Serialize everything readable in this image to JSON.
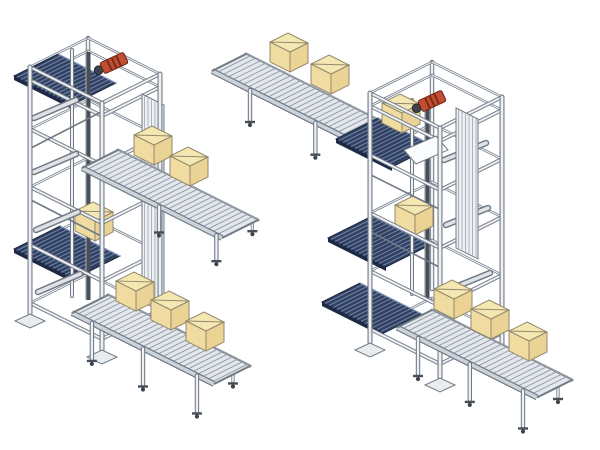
{
  "scene": {
    "width": 600,
    "height": 450,
    "background": "#ffffff"
  },
  "palette": {
    "frame_stroke": "#707a85",
    "frame_light": "#eef0f3",
    "frame_dark": "#474e57",
    "rail_light": "#ccd3da",
    "surface": "#e4e8ec",
    "roller": "#97a1ac",
    "belt": "#31405f",
    "belt_streak": "#7084ab",
    "belt_edge": "#1e2a45",
    "box_top": "#f5e7b2",
    "box_left": "#f0dca1",
    "box_right": "#ebd395",
    "box_stroke": "#93896c",
    "motor_red": "#c14e30",
    "motor_dark": "#7c2b18",
    "pulley": "#3d434b",
    "foot": "#e9ecef",
    "chute": "#fbfcfd"
  },
  "box_size": {
    "wa": 20,
    "wb": 18,
    "h": 20
  },
  "machines": [
    {
      "name": "vertical-conveyor-lift-left",
      "tower": {
        "n": [
          88,
          38
        ],
        "wa": 72,
        "wb": 58,
        "post_h": 252,
        "rings": [
          {
            "dy": 0
          },
          {
            "dy": 13
          },
          {
            "dy": 62
          },
          {
            "dy": 120
          },
          {
            "dy": 178
          },
          {
            "dy": 236
          }
        ],
        "decks": [
          {
            "p": [
              58,
              54
            ],
            "la": 58,
            "lb": 44
          },
          {
            "p": [
              60,
              226
            ],
            "la": 60,
            "lb": 46
          }
        ],
        "column": {
          "x": 88,
          "y1": 52,
          "y2": 300
        },
        "mast": {
          "x": 72,
          "y1": 50,
          "y2": 296
        },
        "arms": [
          [
            34,
            118,
            76,
            100
          ],
          [
            34,
            172,
            76,
            154
          ],
          [
            36,
            230,
            78,
            212
          ],
          [
            38,
            292,
            80,
            274
          ]
        ],
        "braces": [
          [
            31,
            148,
            101,
            112
          ],
          [
            31,
            200,
            101,
            236
          ]
        ],
        "guide_panel": {
          "p": [
            142,
            94
          ],
          "w": 22,
          "h": 200
        },
        "motor": {
          "cx": 114,
          "cy": 63,
          "angle": -25
        }
      },
      "tower_boxes": [
        {
          "n": [
            93,
            202
          ]
        }
      ],
      "conveyors": [
        {
          "name": "mid-level-outfeed-roller-conveyor",
          "layer": "front",
          "p": [
            118,
            150
          ],
          "len": 140,
          "w": 36,
          "leg_h": 24,
          "legs": [
            0.55,
            0.96
          ],
          "boxes": [
            {
              "n": [
                152,
                126
              ]
            },
            {
              "n": [
                188,
                147
              ]
            }
          ]
        },
        {
          "name": "bottom-outfeed-roller-conveyor",
          "layer": "front",
          "p": [
            108,
            295
          ],
          "len": 142,
          "w": 36,
          "leg_h": 36,
          "legs": [
            0.14,
            0.5,
            0.88
          ],
          "boxes": [
            {
              "n": [
                134,
                272
              ]
            },
            {
              "n": [
                169,
                291
              ]
            },
            {
              "n": [
                204,
                312
              ]
            }
          ]
        }
      ]
    },
    {
      "name": "vertical-conveyor-lift-right",
      "tower": {
        "n": [
          432,
          62
        ],
        "wa": 70,
        "wb": 62,
        "post_h": 255,
        "rings": [
          {
            "dy": 0
          },
          {
            "dy": 13
          },
          {
            "dy": 62
          },
          {
            "dy": 120
          },
          {
            "dy": 178
          },
          {
            "dy": 236
          }
        ],
        "decks": [
          {
            "p": [
              378,
              118
            ],
            "la": 56,
            "lb": 42
          },
          {
            "p": [
              372,
              216
            ],
            "la": 58,
            "lb": 44
          },
          {
            "p": [
              360,
              283
            ],
            "la": 62,
            "lb": 38
          }
        ],
        "column": {
          "x": 427,
          "y1": 105,
          "y2": 298
        },
        "mast": {
          "x": 412,
          "y1": 100,
          "y2": 294
        },
        "arms": [
          [
            444,
            160,
            486,
            143
          ],
          [
            446,
            225,
            488,
            208
          ],
          [
            448,
            290,
            490,
            273
          ]
        ],
        "braces": [
          [
            371,
            175,
            441,
            210
          ],
          [
            371,
            232,
            441,
            268
          ]
        ],
        "guide_panel": {
          "p": [
            456,
            108
          ],
          "w": 22,
          "h": 140
        },
        "chute": [
          [
            404,
            150
          ],
          [
            436,
            136
          ],
          [
            448,
            150
          ],
          [
            416,
            164
          ]
        ],
        "motor": {
          "cx": 432,
          "cy": 101,
          "angle": -25
        }
      },
      "tower_boxes": [
        {
          "n": [
            400,
            94
          ]
        },
        {
          "n": [
            413,
            196
          ]
        }
      ],
      "conveyors": [
        {
          "name": "top-infeed-roller-conveyor",
          "layer": "behind",
          "p": [
            246,
            54
          ],
          "len": 152,
          "w": 34,
          "leg_h": 30,
          "legs": [
            0.25,
            0.68
          ],
          "boxes": [
            {
              "n": [
                288,
                33
              ]
            },
            {
              "n": [
                329,
                55
              ]
            }
          ]
        },
        {
          "name": "bottom-outfeed-roller-conveyor",
          "layer": "front",
          "p": [
            432,
            310
          ],
          "len": 140,
          "w": 35,
          "leg_h": 36,
          "legs": [
            0.15,
            0.52,
            0.9
          ],
          "boxes": [
            {
              "n": [
                452,
                280
              ]
            },
            {
              "n": [
                489,
                300
              ]
            },
            {
              "n": [
                527,
                322
              ]
            }
          ]
        }
      ]
    }
  ]
}
